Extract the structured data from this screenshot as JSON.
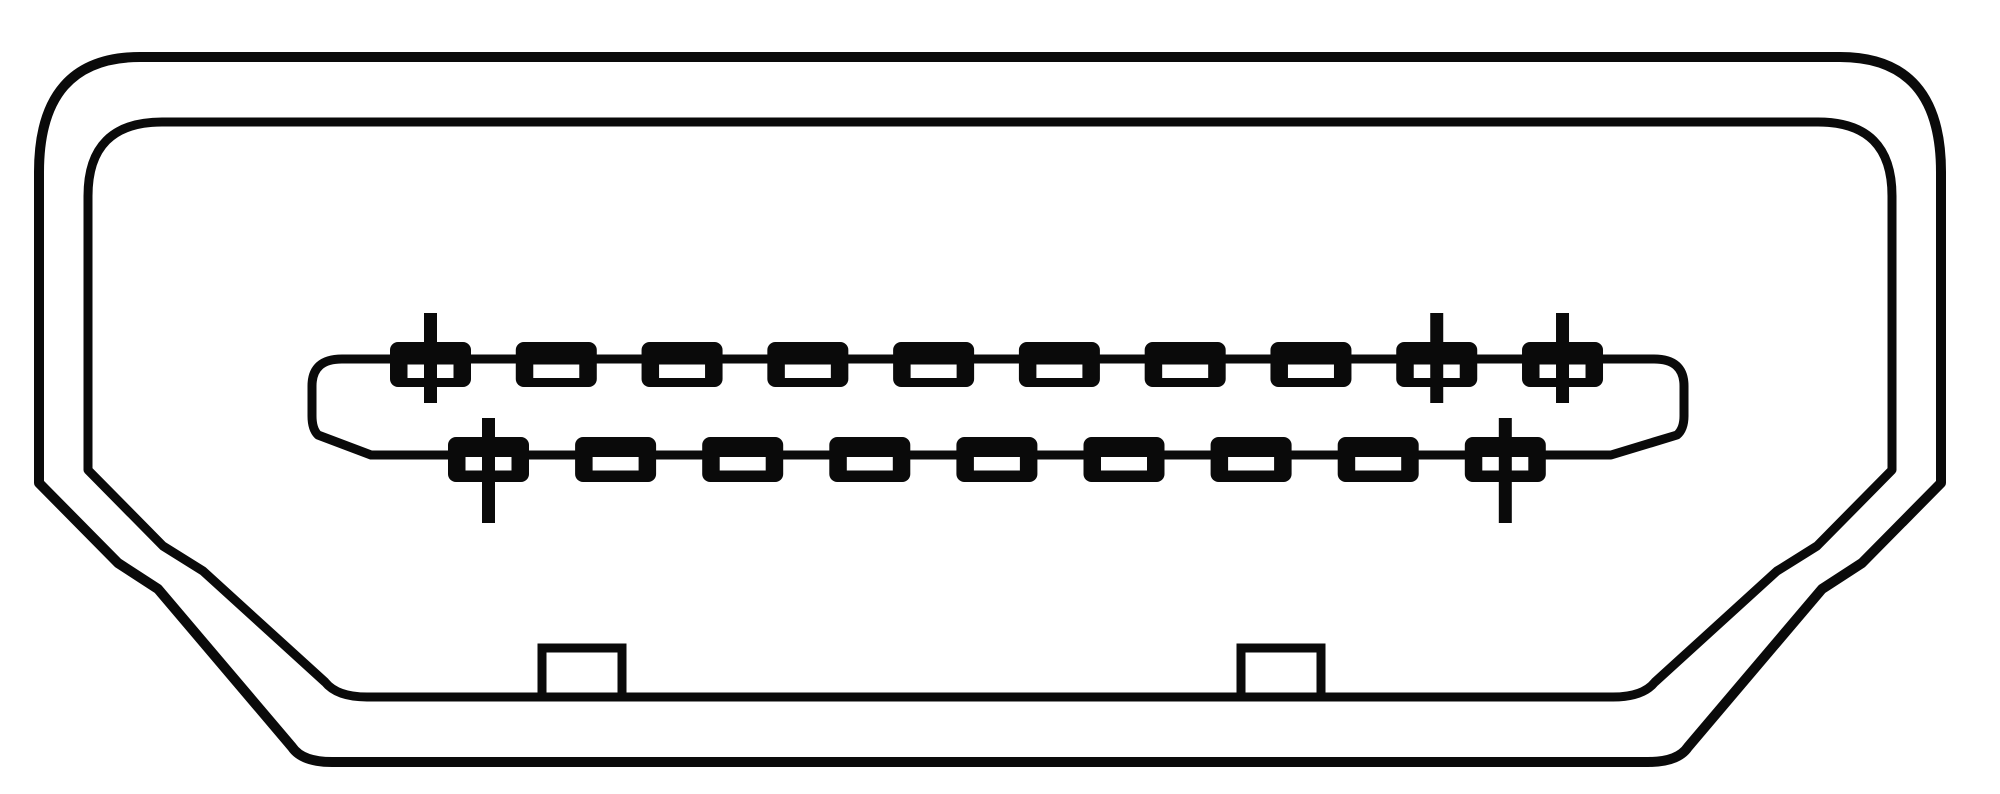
{
  "diagram": {
    "name": "hdmi-type-a-connector-front-view",
    "colors": {
      "line": "#0a0a0a",
      "background": "#ffffff"
    },
    "canvas": {
      "width": 2000,
      "height": 794
    },
    "outlines": {
      "outer": {
        "name": "outer-shell-outline",
        "stroke_width": 10,
        "path": "M 140,57 L 1840,57 Q 1941,57 1941,172 L 1941,483 L 1862,563 L 1822,589 L 1688,747 Q 1678,762 1648,762 L 332,762 Q 302,762 292,747 L 158,589 L 118,563 L 39,483 L 39,172 Q 39,57 140,57 Z"
      },
      "inner": {
        "name": "inner-shell-outline",
        "stroke_width": 9,
        "path": "M 162,122 L 1818,122 Q 1892,122 1892,196 L 1892,470 L 1817,546 L 1777,571 L 1655,682 Q 1643,697 1613,697 L 367,697 Q 337,697 325,682 L 203,571 L 163,546 L 88,470 L 88,196 Q 88,122 162,122 Z"
      },
      "blade": {
        "name": "blade-outline",
        "stroke_width": 9,
        "path": "M 342,359 L 1654,359 Q 1684,359 1684,386 L 1684,416 Q 1684,429 1677,435 L 1611,455 L 371,455 L 318,435 Q 312,429 312,416 L 312,386 Q 312,359 342,359 Z"
      }
    },
    "pin_rows": [
      {
        "name": "top",
        "count": 10,
        "start_x": 390,
        "pitch": 125.78,
        "block": {
          "y": 342,
          "width": 81,
          "height": 45,
          "radius": 8
        },
        "slot": {
          "width": 46,
          "height": 13.5,
          "y": 364.5
        },
        "crosshair_pins": [
          0,
          8,
          9
        ],
        "stem": {
          "width": 13,
          "y_top": 313,
          "y_bottom": 403
        }
      },
      {
        "name": "bottom",
        "count": 9,
        "start_x": 448,
        "pitch": 127.1,
        "block": {
          "y": 437,
          "width": 81,
          "height": 45,
          "radius": 8
        },
        "slot": {
          "width": 46,
          "height": 13.5,
          "y": 457
        },
        "crosshair_pins": [
          0,
          8
        ],
        "stem": {
          "width": 13,
          "y_top": 418,
          "y_bottom": 523
        }
      }
    ],
    "notches": [
      {
        "x": 542,
        "width": 80,
        "y_top": 648,
        "y_bottom": 701,
        "stroke_width": 9
      },
      {
        "x": 1241,
        "width": 80,
        "y_top": 648,
        "y_bottom": 701,
        "stroke_width": 9
      }
    ]
  }
}
